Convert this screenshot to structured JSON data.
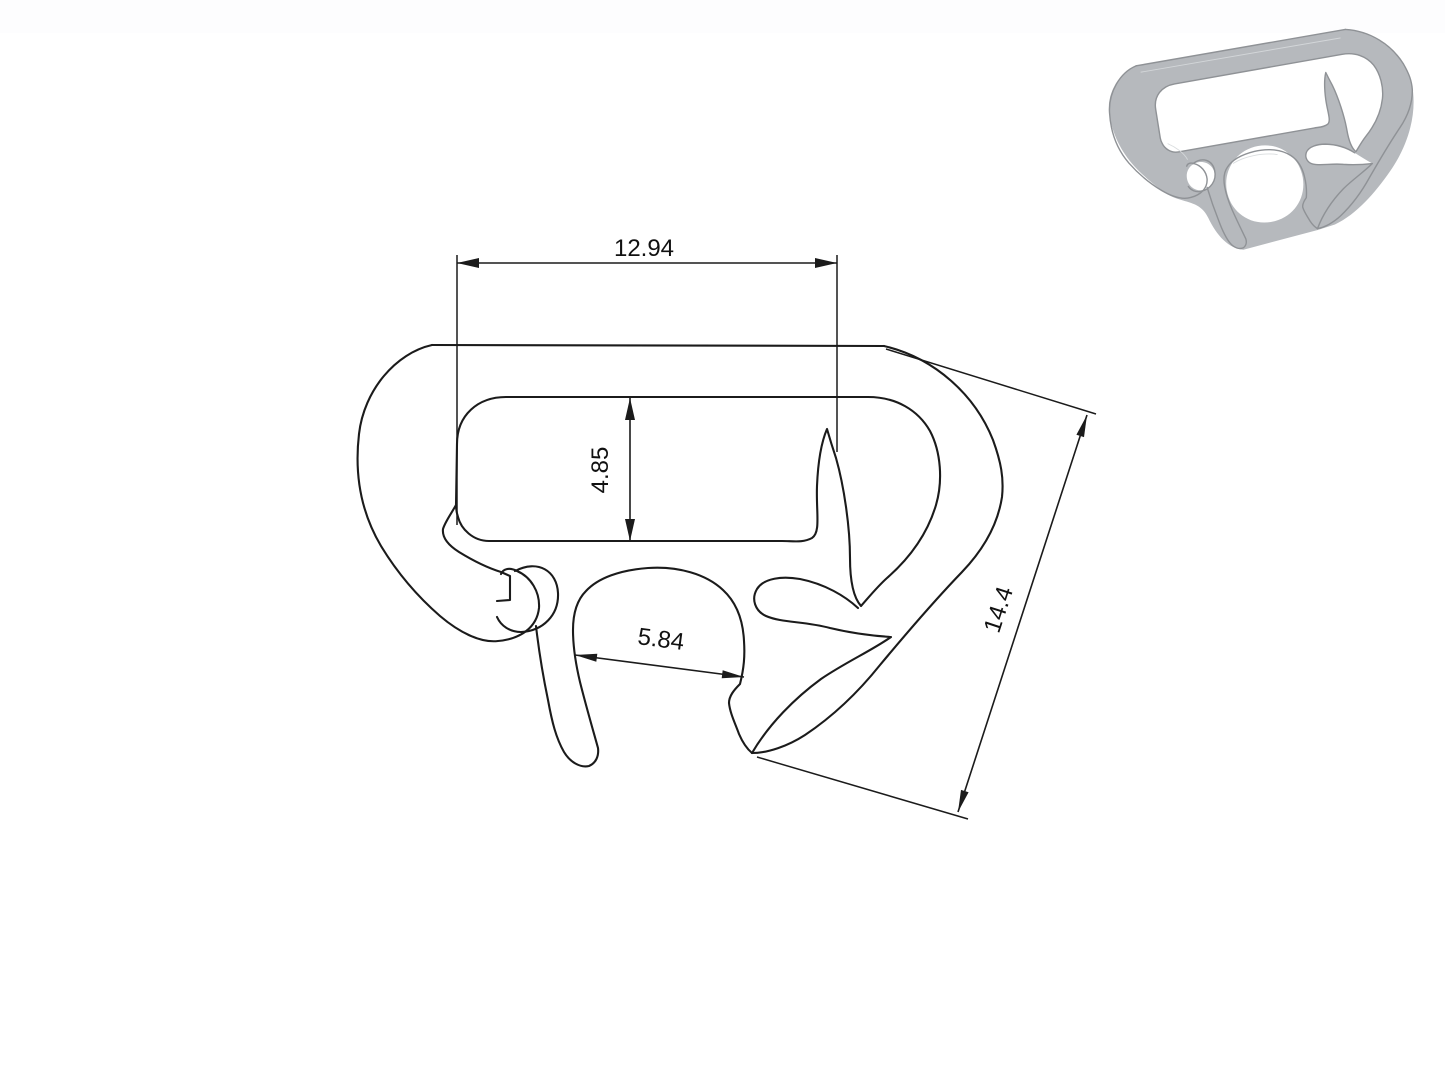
{
  "title": "extrusion-profile-cross-section-drawing",
  "drawing": {
    "line_color": "#1b1b1b",
    "dimensions": [
      {
        "name": "top-width",
        "label": "12.94"
      },
      {
        "name": "inner-cavity-height",
        "label": "4.85"
      },
      {
        "name": "bottom-channel-width",
        "label": "5.84"
      },
      {
        "name": "overall-diagonal-height",
        "label": "14.4"
      }
    ]
  },
  "render": {
    "description": "gray-plastic-profile-clip-3d-view",
    "body_color": "#b6b9bd",
    "edge_color": "#8f9296",
    "highlight_color": "#d6d9dc"
  }
}
